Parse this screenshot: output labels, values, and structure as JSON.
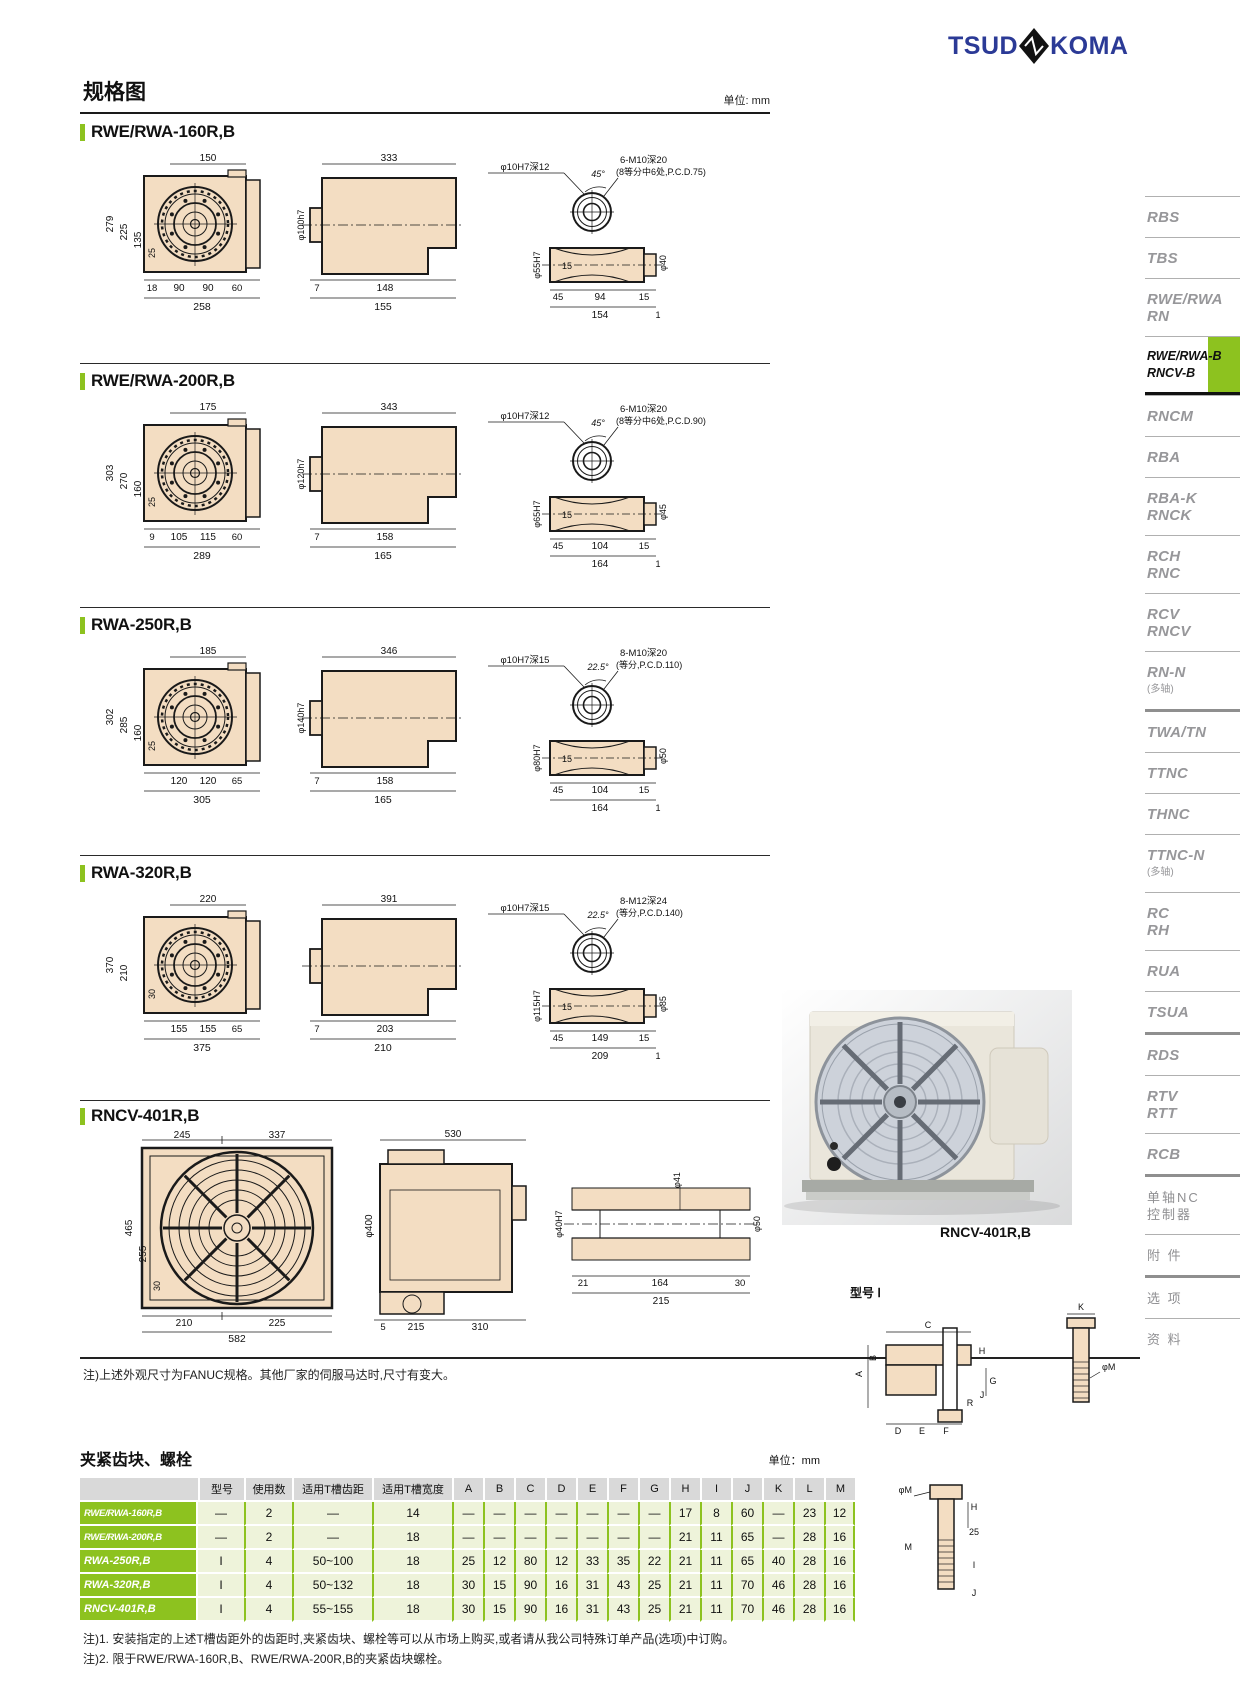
{
  "logo": {
    "part1": "TSUD",
    "part2": "KOMA"
  },
  "page": {
    "title": "规格图",
    "unit": "单位: mm",
    "note": "注)上述外观尺寸为FANUC规格。其他厂家的伺服马达时,尺寸有变大。"
  },
  "sections": [
    {
      "title": "RWE/RWA-160R,B",
      "front": {
        "top": "150",
        "l1": "279",
        "l2": "225",
        "l3": "135",
        "l4": "25",
        "b1": "18",
        "b2": "90",
        "b3": "90",
        "b4": "60",
        "total": "258"
      },
      "side": {
        "top": "333",
        "dia": "φ100h7",
        "b1": "7",
        "b2": "148",
        "total": "155"
      },
      "detail": {
        "hole": "φ10H7深12",
        "angle": "45°",
        "bolt1": "6-M10深20",
        "bolt2": "(8等分中6处,P.C.D.75)",
        "diaL": "φ55H7",
        "diaR": "φ40",
        "mid": "15",
        "s1": "45",
        "s2": "94",
        "s3": "15",
        "t1": "154",
        "t2": "1"
      }
    },
    {
      "title": "RWE/RWA-200R,B",
      "front": {
        "top": "175",
        "l1": "303",
        "l2": "270",
        "l3": "160",
        "l4": "25",
        "b1": "9",
        "b2": "105",
        "b3": "115",
        "b4": "60",
        "total": "289"
      },
      "side": {
        "top": "343",
        "dia": "φ120h7",
        "b1": "7",
        "b2": "158",
        "total": "165"
      },
      "detail": {
        "hole": "φ10H7深12",
        "angle": "45°",
        "bolt1": "6-M10深20",
        "bolt2": "(8等分中6处,P.C.D.90)",
        "diaL": "φ65H7",
        "diaR": "φ45",
        "mid": "15",
        "s1": "45",
        "s2": "104",
        "s3": "15",
        "t1": "164",
        "t2": "1"
      }
    },
    {
      "title": "RWA-250R,B",
      "front": {
        "top": "185",
        "l1": "302",
        "l2": "285",
        "l3": "160",
        "l4": "25",
        "b1": "",
        "b2": "120",
        "b3": "120",
        "b4": "65",
        "total": "305"
      },
      "side": {
        "top": "346",
        "dia": "φ140h7",
        "b1": "7",
        "b2": "158",
        "total": "165"
      },
      "detail": {
        "hole": "φ10H7深15",
        "angle": "22.5°",
        "bolt1": "8-M10深20",
        "bolt2": "(等分,P.C.D.110)",
        "diaL": "φ80H7",
        "diaR": "φ50",
        "mid": "15",
        "s1": "45",
        "s2": "104",
        "s3": "15",
        "t1": "164",
        "t2": "1"
      }
    },
    {
      "title": "RWA-320R,B",
      "front": {
        "top": "220",
        "l1": "370",
        "l2": "210",
        "l3": "",
        "l4": "30",
        "b1": "",
        "b2": "155",
        "b3": "155",
        "b4": "65",
        "total": "375"
      },
      "side": {
        "top": "391",
        "dia": "",
        "b1": "7",
        "b2": "203",
        "total": "210"
      },
      "detail": {
        "hole": "φ10H7深15",
        "angle": "22.5°",
        "bolt1": "8-M12深24",
        "bolt2": "(等分,P.C.D.140)",
        "diaL": "φ115H7",
        "diaR": "φ85",
        "mid": "15",
        "s1": "45",
        "s2": "149",
        "s3": "15",
        "t1": "209",
        "t2": "1"
      }
    },
    {
      "title": "RNCV-401R,B",
      "front": {
        "topL": "245",
        "topR": "337",
        "l1": "465",
        "l2": "255",
        "l3": "30",
        "b1": "210",
        "b2": "225",
        "total": "582"
      },
      "side": {
        "top": "530",
        "dia": "φ400",
        "b1": "5",
        "b2": "215",
        "b3": "310"
      },
      "shaft": {
        "d1": "φ41",
        "d2": "φ40H7",
        "d3": "φ50",
        "b1": "21",
        "b2": "164",
        "b3": "30",
        "total": "215"
      }
    }
  ],
  "photo": {
    "caption": "RNCV-401R,B"
  },
  "sidebar": {
    "items": [
      {
        "lines": [
          "RBS"
        ]
      },
      {
        "lines": [
          "TBS"
        ]
      },
      {
        "lines": [
          "RWE/RWA",
          "RN"
        ]
      },
      {
        "lines": [
          "RWE/RWA-B",
          "RNCV-B"
        ],
        "active": true
      },
      {
        "lines": [
          "RNCM"
        ]
      },
      {
        "lines": [
          "RBA"
        ]
      },
      {
        "lines": [
          "RBA-K",
          "RNCK"
        ]
      },
      {
        "lines": [
          "RCH",
          "RNC"
        ]
      },
      {
        "lines": [
          "RCV",
          "RNCV"
        ]
      },
      {
        "lines": [
          "RN-N",
          "(多轴)"
        ]
      },
      {
        "lines": [
          "TWA/TN"
        ],
        "thick": true
      },
      {
        "lines": [
          "TTNC"
        ]
      },
      {
        "lines": [
          "THNC"
        ]
      },
      {
        "lines": [
          "TTNC-N",
          "(多轴)"
        ]
      },
      {
        "lines": [
          "RC",
          "RH"
        ]
      },
      {
        "lines": [
          "RUA"
        ]
      },
      {
        "lines": [
          "TSUA"
        ]
      },
      {
        "lines": [
          "RDS"
        ],
        "thick": true
      },
      {
        "lines": [
          "RTV",
          "RTT"
        ]
      },
      {
        "lines": [
          "RCB"
        ]
      },
      {
        "lines": [
          "单轴NC",
          "控制器"
        ],
        "cn": true,
        "thick": true
      },
      {
        "lines": [
          "附 件"
        ],
        "cn": true
      },
      {
        "lines": [
          "选 项"
        ],
        "cn": true,
        "thick": true
      },
      {
        "lines": [
          "资 料"
        ],
        "cn": true
      }
    ]
  },
  "clamp": {
    "title": "夹紧齿块、螺栓",
    "unit": "单位：mm",
    "headers": [
      "",
      "型号",
      "使用数",
      "适用T槽齿距",
      "适用T槽宽度",
      "A",
      "B",
      "C",
      "D",
      "E",
      "F",
      "G",
      "H",
      "I",
      "J",
      "K",
      "L",
      "M"
    ],
    "rows": [
      [
        "RWE/RWA-160R,B",
        "—",
        "2",
        "—",
        "14",
        "—",
        "—",
        "—",
        "—",
        "—",
        "—",
        "—",
        "17",
        "8",
        "60",
        "—",
        "23",
        "12"
      ],
      [
        "RWE/RWA-200R,B",
        "—",
        "2",
        "—",
        "18",
        "—",
        "—",
        "—",
        "—",
        "—",
        "—",
        "—",
        "21",
        "11",
        "65",
        "—",
        "28",
        "16"
      ],
      [
        "RWA-250R,B",
        "I",
        "4",
        "50~100",
        "18",
        "25",
        "12",
        "80",
        "12",
        "33",
        "35",
        "22",
        "21",
        "11",
        "65",
        "40",
        "28",
        "16"
      ],
      [
        "RWA-320R,B",
        "I",
        "4",
        "50~132",
        "18",
        "30",
        "15",
        "90",
        "16",
        "31",
        "43",
        "25",
        "21",
        "11",
        "70",
        "46",
        "28",
        "16"
      ],
      [
        "RNCV-401R,B",
        "I",
        "4",
        "55~155",
        "18",
        "30",
        "15",
        "90",
        "16",
        "31",
        "43",
        "25",
        "21",
        "11",
        "70",
        "46",
        "28",
        "16"
      ]
    ],
    "notes": [
      "注)1. 安装指定的上述T槽齿距外的齿距时,夹紧齿块、螺栓等可以从市场上购买,或者请从我公司特殊订单产品(选项)中订购。",
      "注)2. 限于RWE/RWA-160R,B、RWE/RWA-200R,B的夹紧齿块螺栓。"
    ]
  },
  "clamp_diagram": {
    "label": "型号 Ⅰ",
    "fig1": [
      "C",
      "K",
      "A",
      "B",
      "G",
      "H",
      "J",
      "D",
      "E",
      "F",
      "R",
      "φM"
    ],
    "fig2": [
      "φM",
      "25",
      "M",
      "H",
      "I",
      "J"
    ]
  }
}
